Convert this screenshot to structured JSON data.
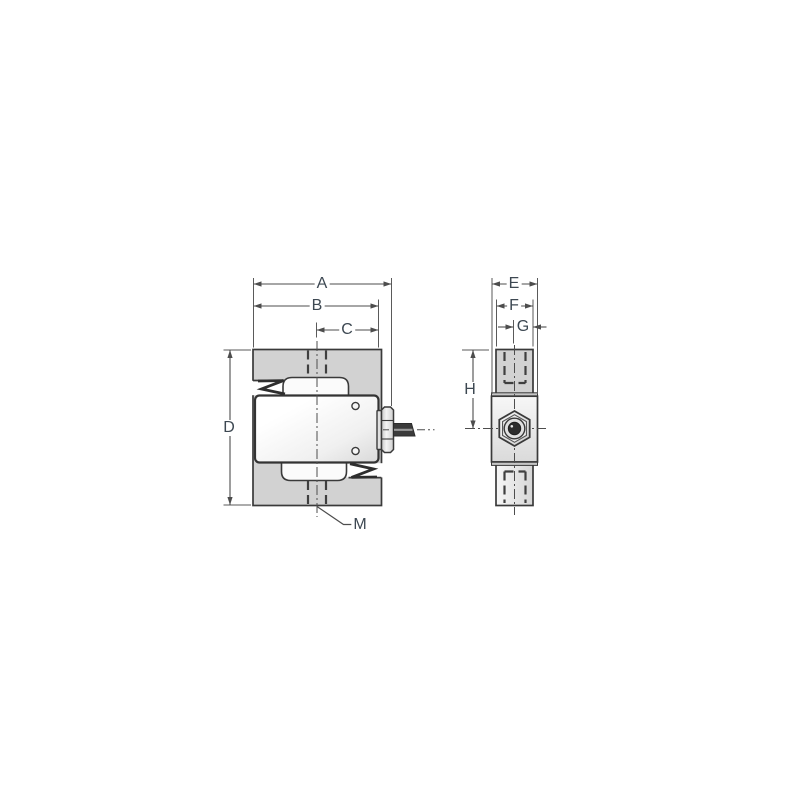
{
  "drawing": {
    "dims": {
      "a": "A",
      "b": "B",
      "c": "C",
      "d": "D",
      "e": "E",
      "f": "F",
      "g": "G",
      "h": "H",
      "m": "M"
    },
    "colors": {
      "outline": "#3a3a3a",
      "dimension_line": "#4d4d4d",
      "label_text": "#3d4852",
      "body_fill": "#d2d2d2",
      "plate_fill_light": "#ffffff",
      "plate_fill_dark": "#dcdcdc",
      "cable_fill": "#3b3b3b",
      "hole_fill": "#2d2d2d"
    }
  }
}
